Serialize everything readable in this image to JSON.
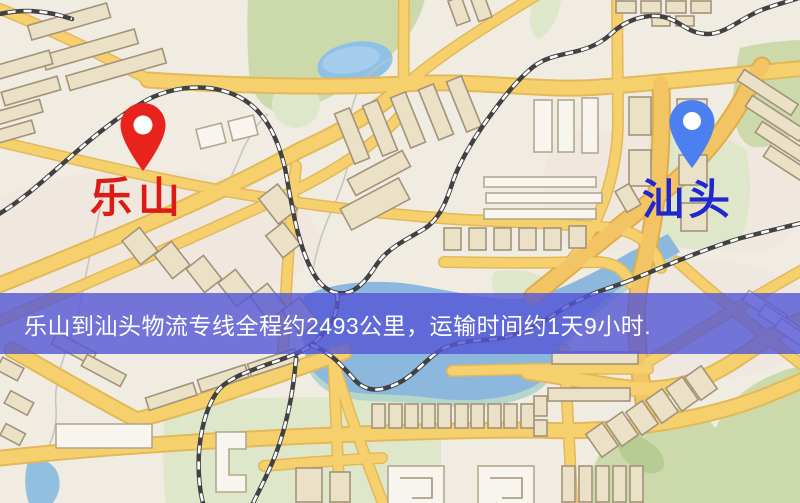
{
  "origin": {
    "label": "乐山",
    "pin_color": "#e8231d",
    "label_color": "#dc1b15"
  },
  "destination": {
    "label": "汕头",
    "pin_color": "#4c80f0",
    "label_color": "#2027cc"
  },
  "banner": {
    "text": "乐山到汕头物流专线全程约2493公里，运输时间约1天9小时.",
    "distance_text": "2493公里",
    "duration_text": "1天9小时",
    "overlay_color": "rgba(84,86,214,0.8)",
    "text_color": "#ffffff"
  },
  "map": {
    "colors": {
      "background": "#f1ece2",
      "road_fill": "#f7d06e",
      "road_casing": "#e2b95a",
      "water": "#8cb8de",
      "water_shallow": "#b7d6cb",
      "park": "#ccd9ab",
      "park_pale": "#dfe7cb",
      "railway": "#414141",
      "building": "#eae1c6",
      "building_outline": "#a3937a"
    }
  }
}
